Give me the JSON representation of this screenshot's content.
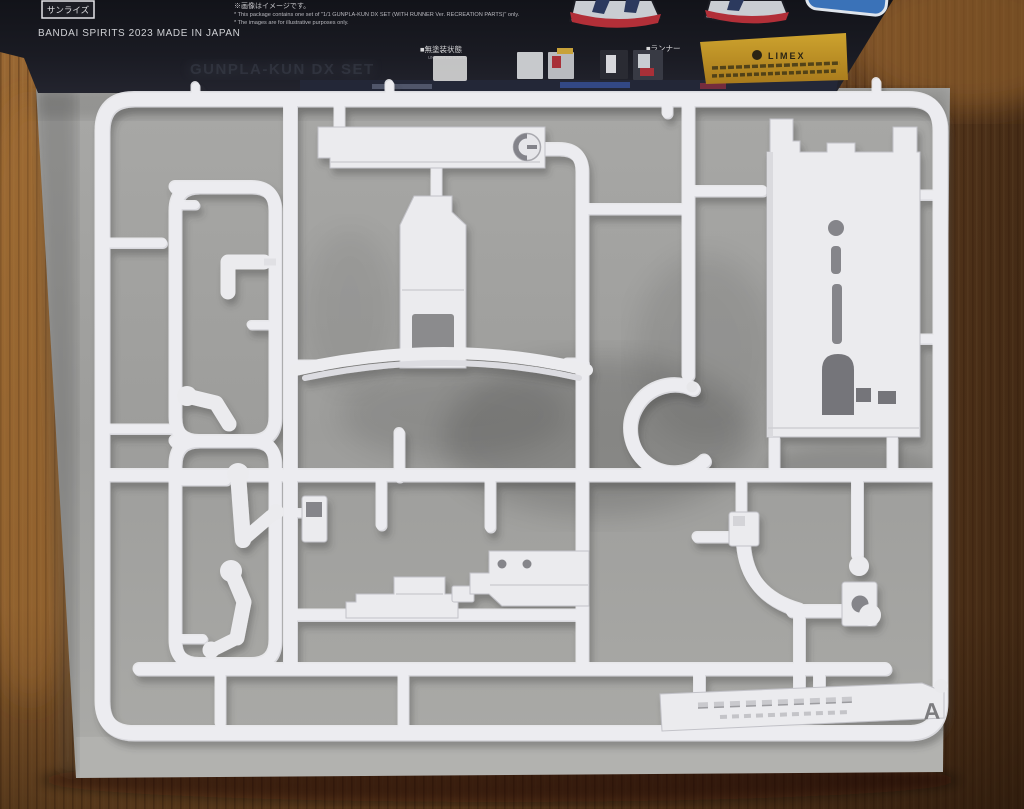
{
  "box": {
    "sunrise_logo": "サンライズ",
    "made_in": "BANDAI SPIRITS 2023 MADE IN JAPAN",
    "disclaimer_jp": "※画像はイメージです。",
    "disclaimer_en1": "* This package contains one set of \"1/1 GUNPLA-KUN DX SET (WITH RUNNER Ver. RECREATION PARTS)\" only.",
    "disclaimer_en2": "* The images are for illustrative purposes only.",
    "ghost_title": "GUNPLA-KUN DX SET",
    "label_unpainted_jp": "■無塗装状態",
    "label_unpainted_en": "UNPAINTED STATE",
    "label_runner_jp": "■ランナー",
    "limex_logo": "LIMEX"
  },
  "runner": {
    "letter": "A"
  },
  "colors": {
    "wood_light": "#a06a33",
    "wood_dark": "#3f2713",
    "box_dark": "#17181f",
    "cardboard_gray": "#a2a2a0",
    "plastic_white": "#ebebee",
    "limex_yellow": "#c09127",
    "art_red": "#b22f38",
    "art_blue": "#3a72b8"
  }
}
